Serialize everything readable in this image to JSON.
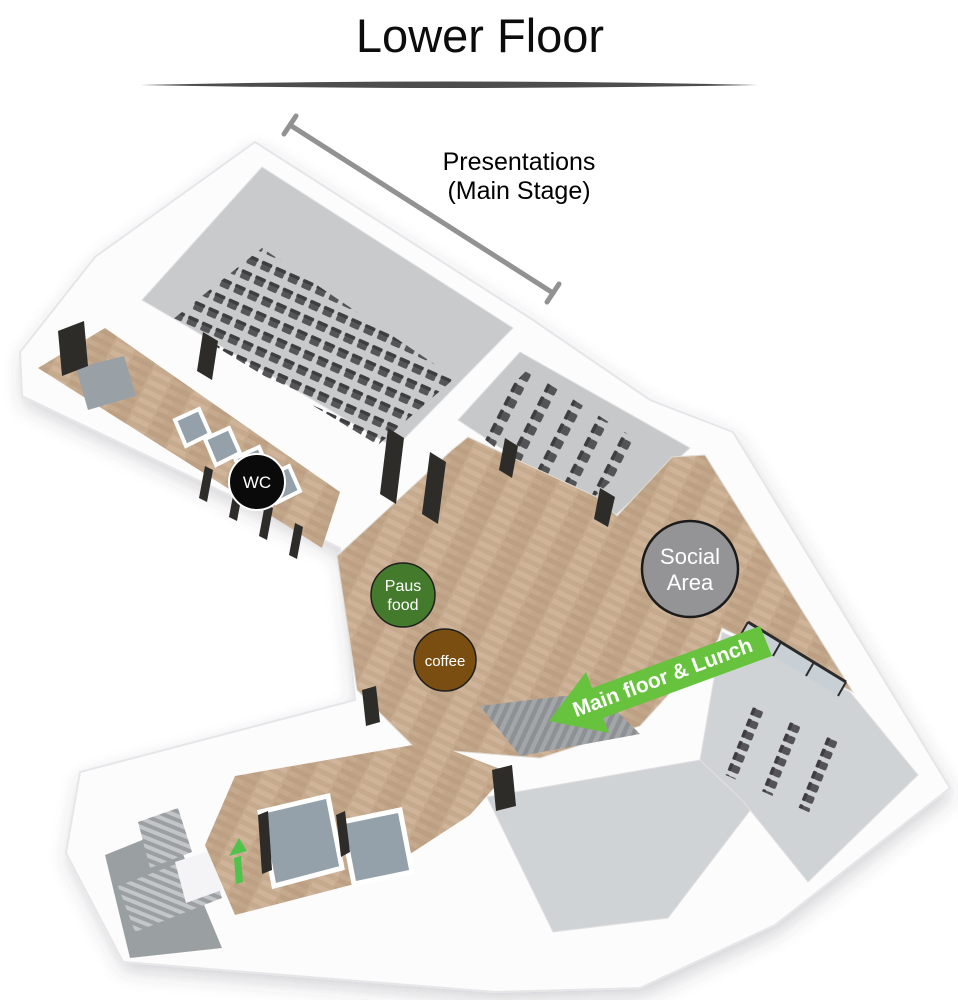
{
  "page": {
    "title": "Lower Floor"
  },
  "annotations": {
    "stage_label": {
      "line1": "Presentations",
      "line2": "(Main Stage)",
      "color": "#000000"
    },
    "dimension_line_color": "#929292",
    "divider_color": "#4d4d4d"
  },
  "badges": {
    "wc": {
      "label": "WC",
      "bg": "#0a0a0a",
      "fg": "#ffffff",
      "border": "#ffffff"
    },
    "paus_food": {
      "line1": "Paus",
      "line2": "food",
      "bg": "#437a2b",
      "fg": "#ffffff",
      "border": "#1f1f1f"
    },
    "coffee": {
      "label": "coffee",
      "bg": "#7a4e10",
      "fg": "#ffffff",
      "border": "#1f1f1f"
    },
    "social_area": {
      "line1": "Social",
      "line2": "Area",
      "bg": "#949496",
      "fg": "#ffffff",
      "border": "#1b1b1b"
    }
  },
  "arrow": {
    "label": "Main floor & Lunch",
    "bg": "#67c33d",
    "fg": "#ffffff"
  },
  "stairs_arrow_color": "#4fc34a",
  "palette": {
    "wall": "#fcfcfd",
    "wall_edge": "#e6e6e9",
    "hall_floor": "#c9cacc",
    "workshop_floor": "#c7c8ca",
    "room_floor": "#d0d3d5",
    "stall_floor": "#94a1ab",
    "stair_landing": "#9aa0a2",
    "entry_mat": "#99a1a7",
    "chair": "#4a4a4c",
    "door": "#2e2c29",
    "stage_steps": "#9da1a3",
    "glass_fill": "#c8d0d5",
    "glass_frame": "#2b2b2b"
  }
}
